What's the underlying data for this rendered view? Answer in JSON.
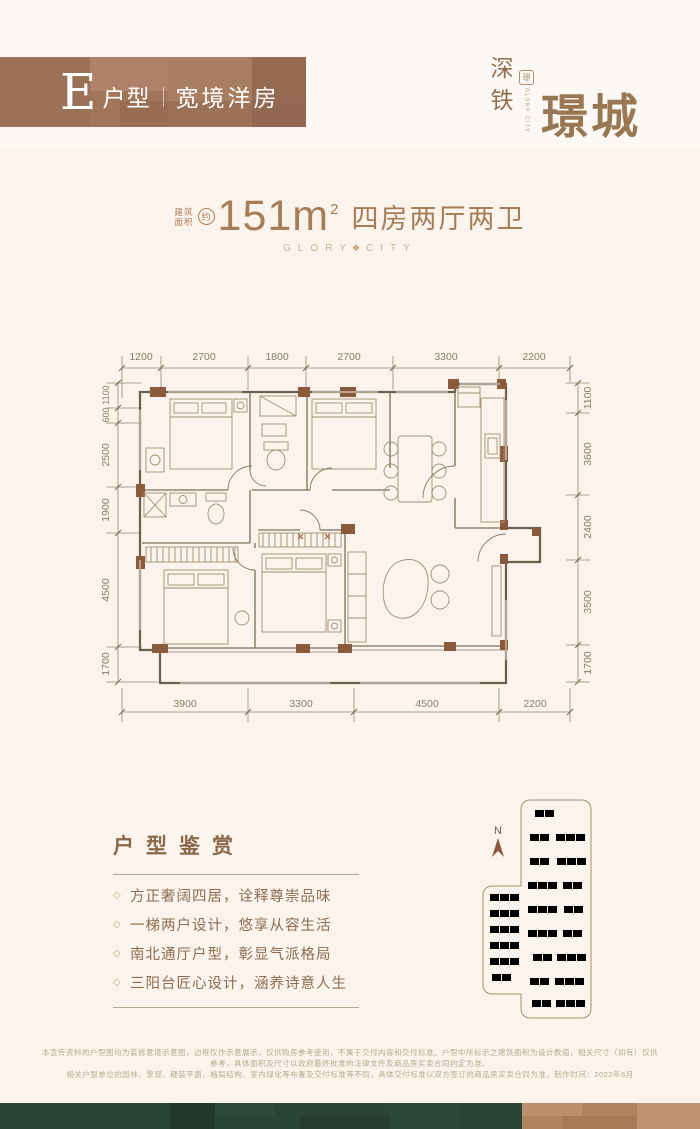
{
  "banner": {
    "unit_letter": "E",
    "unit_label": "户型",
    "subtitle": "宽境洋房"
  },
  "logo": {
    "brand_vertical": "深铁",
    "brand_main": "璟城",
    "brand_eng": "GLORY CITY",
    "seal_char": "璟"
  },
  "spec": {
    "area_label_top": "建筑",
    "area_label_bottom": "面积",
    "approx": "约",
    "area_value": "151m",
    "area_sup": "2",
    "rooms": "四房两厅两卫",
    "tagline_left": "GLORY",
    "tagline_right": "CITY",
    "tagline_icon": "❖"
  },
  "floorplan": {
    "dims_top": [
      "1200",
      "2700",
      "1800",
      "2700",
      "3300",
      "2200"
    ],
    "dims_bottom": [
      "3900",
      "3300",
      "4500",
      "2200"
    ],
    "dims_left": [
      "1100",
      "600",
      "2500",
      "1900",
      "4500",
      "1700"
    ],
    "dims_right": [
      "1100",
      "3600",
      "2400",
      "3500",
      "1700"
    ]
  },
  "highlights": {
    "title": "户型鉴赏",
    "marker": "◇",
    "items": [
      "方正奢阔四居，诠释尊崇品味",
      "一梯两户设计，悠享从容生活",
      "南北通厅户型，彰显气派格局",
      "三阳台匠心设计，涵养诗意人生"
    ]
  },
  "siteplan": {
    "north_label": "N"
  },
  "disclaimer": {
    "line1": "本宣传资料的户型图均为装修意境示意图，边框仅作示意展示，仅供购房参考使用，不属于交付内容和交付标准。户型中所标示之建筑面积为设计数值，相关尺寸（如有）仅供参考，具体面积及尺寸以政府最终批准的法律文件及商品房买卖合同约定为准。",
    "line2": "相关户型单位的园林、景观、硬装平面、格局结构、室内绿化等布置及交付标准等不同，具体交付标准以双方签订的商品房买卖合同为准。制作时间：2022年6月"
  },
  "colors": {
    "accent_brown": "#9c7a58",
    "wall_pier_brown": "#8a5a3c",
    "footer_green": "#2a4436",
    "footer_brown": "#b2835f",
    "text_brown": "#8d6c50",
    "tagline_tan": "#cbb295"
  }
}
